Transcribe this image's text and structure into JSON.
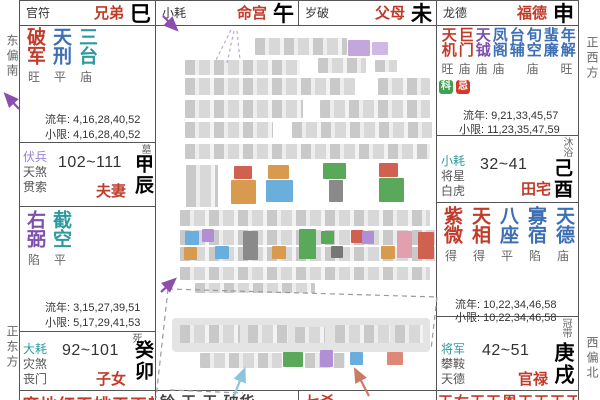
{
  "colors": {
    "red": "#c13b2a",
    "blue": "#3d6fb4",
    "teal": "#2d9aa0",
    "purple": "#7d4fae",
    "badge_ke": "#3fa04d",
    "badge_ji": "#d23b2a"
  },
  "sides": {
    "left_top": "东偏南",
    "left_bottom": "正东方",
    "right_top": "正西方",
    "right_bottom": "西偏北"
  },
  "top_row": [
    {
      "god": "官符",
      "name": "兄弟",
      "branch": "巳"
    },
    {
      "god": "小耗",
      "name": "命宫",
      "branch": "午"
    },
    {
      "god": "岁破",
      "name": "父母",
      "branch": "未"
    },
    {
      "god": "龙德",
      "name": "福德",
      "branch": "申"
    }
  ],
  "left": {
    "brothers_body": {
      "stars": [
        {
          "n": "破军",
          "g": "旺"
        },
        {
          "n": "天刑",
          "g": "平"
        },
        {
          "n": "三台",
          "g": "庙"
        }
      ],
      "liunian": "流年: 4,16,28,40,52",
      "xiaoxian": "小限: 4,16,28,40,52"
    },
    "spouse": {
      "sheng": "墓",
      "gods": [
        "伏兵",
        "天煞",
        "贯索"
      ],
      "range": "102~111",
      "name": "夫妻",
      "branch": "甲辰",
      "stars": [
        {
          "n": "右弼",
          "g": "陷"
        },
        {
          "n": "截空",
          "g": "平"
        }
      ],
      "liunian": "流年: 3,15,27,39,51",
      "xiaoxian": "小限: 5,17,29,41,53"
    },
    "children": {
      "sheng": "死",
      "gods": [
        "大耗",
        "灾煞",
        "丧门"
      ],
      "range": "92~101",
      "name": "子女",
      "branch": "癸卯",
      "clipped": "廉地红天姚天巫耗"
    }
  },
  "right": {
    "fortune_body": {
      "stars": [
        {
          "n": "天机",
          "g": "旺"
        },
        {
          "n": "巨门",
          "g": "庙"
        },
        {
          "n": "天钺",
          "g": "庙"
        },
        {
          "n": "凤阁",
          "g": "庙"
        },
        {
          "n": "台辅",
          "g": ""
        },
        {
          "n": "旬空",
          "g": "庙"
        },
        {
          "n": "蜚廉",
          "g": ""
        },
        {
          "n": "年解",
          "g": "旺"
        }
      ],
      "badges": [
        "科",
        "忌"
      ],
      "liunian": "流年: 9,21,33,45,57",
      "xiaoxian": "小限: 11,23,35,47,59"
    },
    "property": {
      "sheng": "沐浴",
      "gods": [
        "小耗",
        "将星",
        "白虎"
      ],
      "range": "32~41",
      "name": "田宅",
      "branch": "己酉",
      "stars": [
        {
          "n": "紫微",
          "g": "得"
        },
        {
          "n": "天相",
          "g": "得"
        },
        {
          "n": "八座",
          "g": "平"
        },
        {
          "n": "寡宿",
          "g": "陷"
        },
        {
          "n": "天德",
          "g": "庙"
        }
      ],
      "liunian": "流年: 10,22,34,46,58",
      "xiaoxian": "小限: 10,22,34,46,58"
    },
    "career": {
      "sheng": "冠带",
      "gods": [
        "将军",
        "攀鞍",
        "天德"
      ],
      "range": "42~51",
      "name": "官禄",
      "branch": "庚戌",
      "clipped": "天右天天恩天天天天"
    }
  },
  "bottom_clipped": {
    "c2": "铃 天 天 破华",
    "c3": "七杀"
  }
}
